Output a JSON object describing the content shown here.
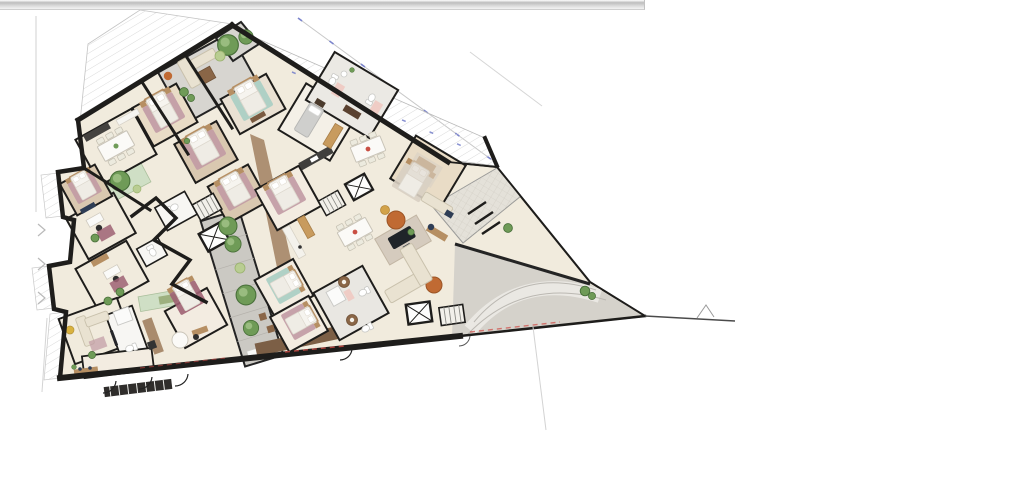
{
  "document": {
    "kind": "rendered architectural floor plan",
    "description": "Top-down furnished apartment-building floor plan, rotated diagonally on a white page, wedge-shaped footprint with hatched terraces, inner courtyard atrium and driveway toward the right tip"
  },
  "window": {
    "horizontal_scrollbar": {
      "present": true,
      "extent": "left edge to about 63% of page width"
    }
  },
  "colors": {
    "wall": "#1e1d1b",
    "floor": "#f1ebdd",
    "floorWarm": "#f3ece1",
    "grayFloor": "#d7d5d0",
    "pave": "#cbc9c3",
    "drive": "#d5d2cb",
    "driveBand": "#e9e7e1",
    "wood": "#b68f63",
    "woodMid": "#a98b6d",
    "woodDark": "#7c5f46",
    "woodFloor1": "#e9dcc6",
    "woodFloor2": "#d9c8b0",
    "bath": "#f7f6f3",
    "green": "#cfdfc5",
    "tree": "#6f9b57",
    "treeDark": "#49703a",
    "treeLight": "#a4c489",
    "bedMauve": "#c19aa4",
    "bedTeal": "#a9cec3",
    "wineRug": "#9e6273",
    "pink": "#f0c7c0",
    "cream": "#e9e2d1",
    "creamLine": "#c9c1ac",
    "rugOrange": "#c06a33",
    "gold": "#c89b5e",
    "blue": "#7b84cc",
    "hatchLine": "#dadada",
    "lineGray": "#c9c9c9",
    "red": "#cf4a45",
    "navy": "#2e3d55",
    "dark": "#2b2b2b"
  },
  "plan": {
    "description": "Wedge-shaped multi-unit residential floor plan rendered in color, rotated about 30 degrees, with bedrooms along the upper-left edge, a central paved atrium with trees, bathrooms and stair/elevator cores in the middle, an open living-dining zone on the right, hatched terraces outside the walls and a gray driveway running to the pointed right tip",
    "areas": [
      "terrace-hatched-top-left",
      "terrace-hatched-upper-right",
      "balcony-hatched-left",
      "apex-roof-terrace",
      "upper-living-room",
      "dining-room",
      "bedrooms",
      "bathrooms",
      "offices",
      "kitchens",
      "atrium-courtyard",
      "green-courtyards",
      "corridor-wood",
      "entrance-tile-path",
      "driveway",
      "garage-entry-hall",
      "lower-living-room"
    ],
    "furniture": [
      "double-bed-with-rug",
      "dining-table-with-chairs",
      "sofa-l-shaped",
      "coffee-table",
      "grand-piano",
      "round-tufted-rug",
      "pouf",
      "desk-with-office-chair",
      "sideboard",
      "kitchen-counter",
      "wardrobe",
      "daybed",
      "toilet",
      "sink",
      "shower",
      "vanity",
      "bench-with-plants",
      "tv-panel"
    ],
    "vertical_circulation": [
      "elevator-shaft",
      "staircase"
    ],
    "vegetation": [
      "tree",
      "shrub",
      "potted-plant"
    ],
    "annotations": [
      "blue-dashed-dimension-marks-along-terrace",
      "red-dashed-marks-along-bottom-wall",
      "gray-survey-boundary-lines",
      "door-swing-arcs"
    ]
  }
}
